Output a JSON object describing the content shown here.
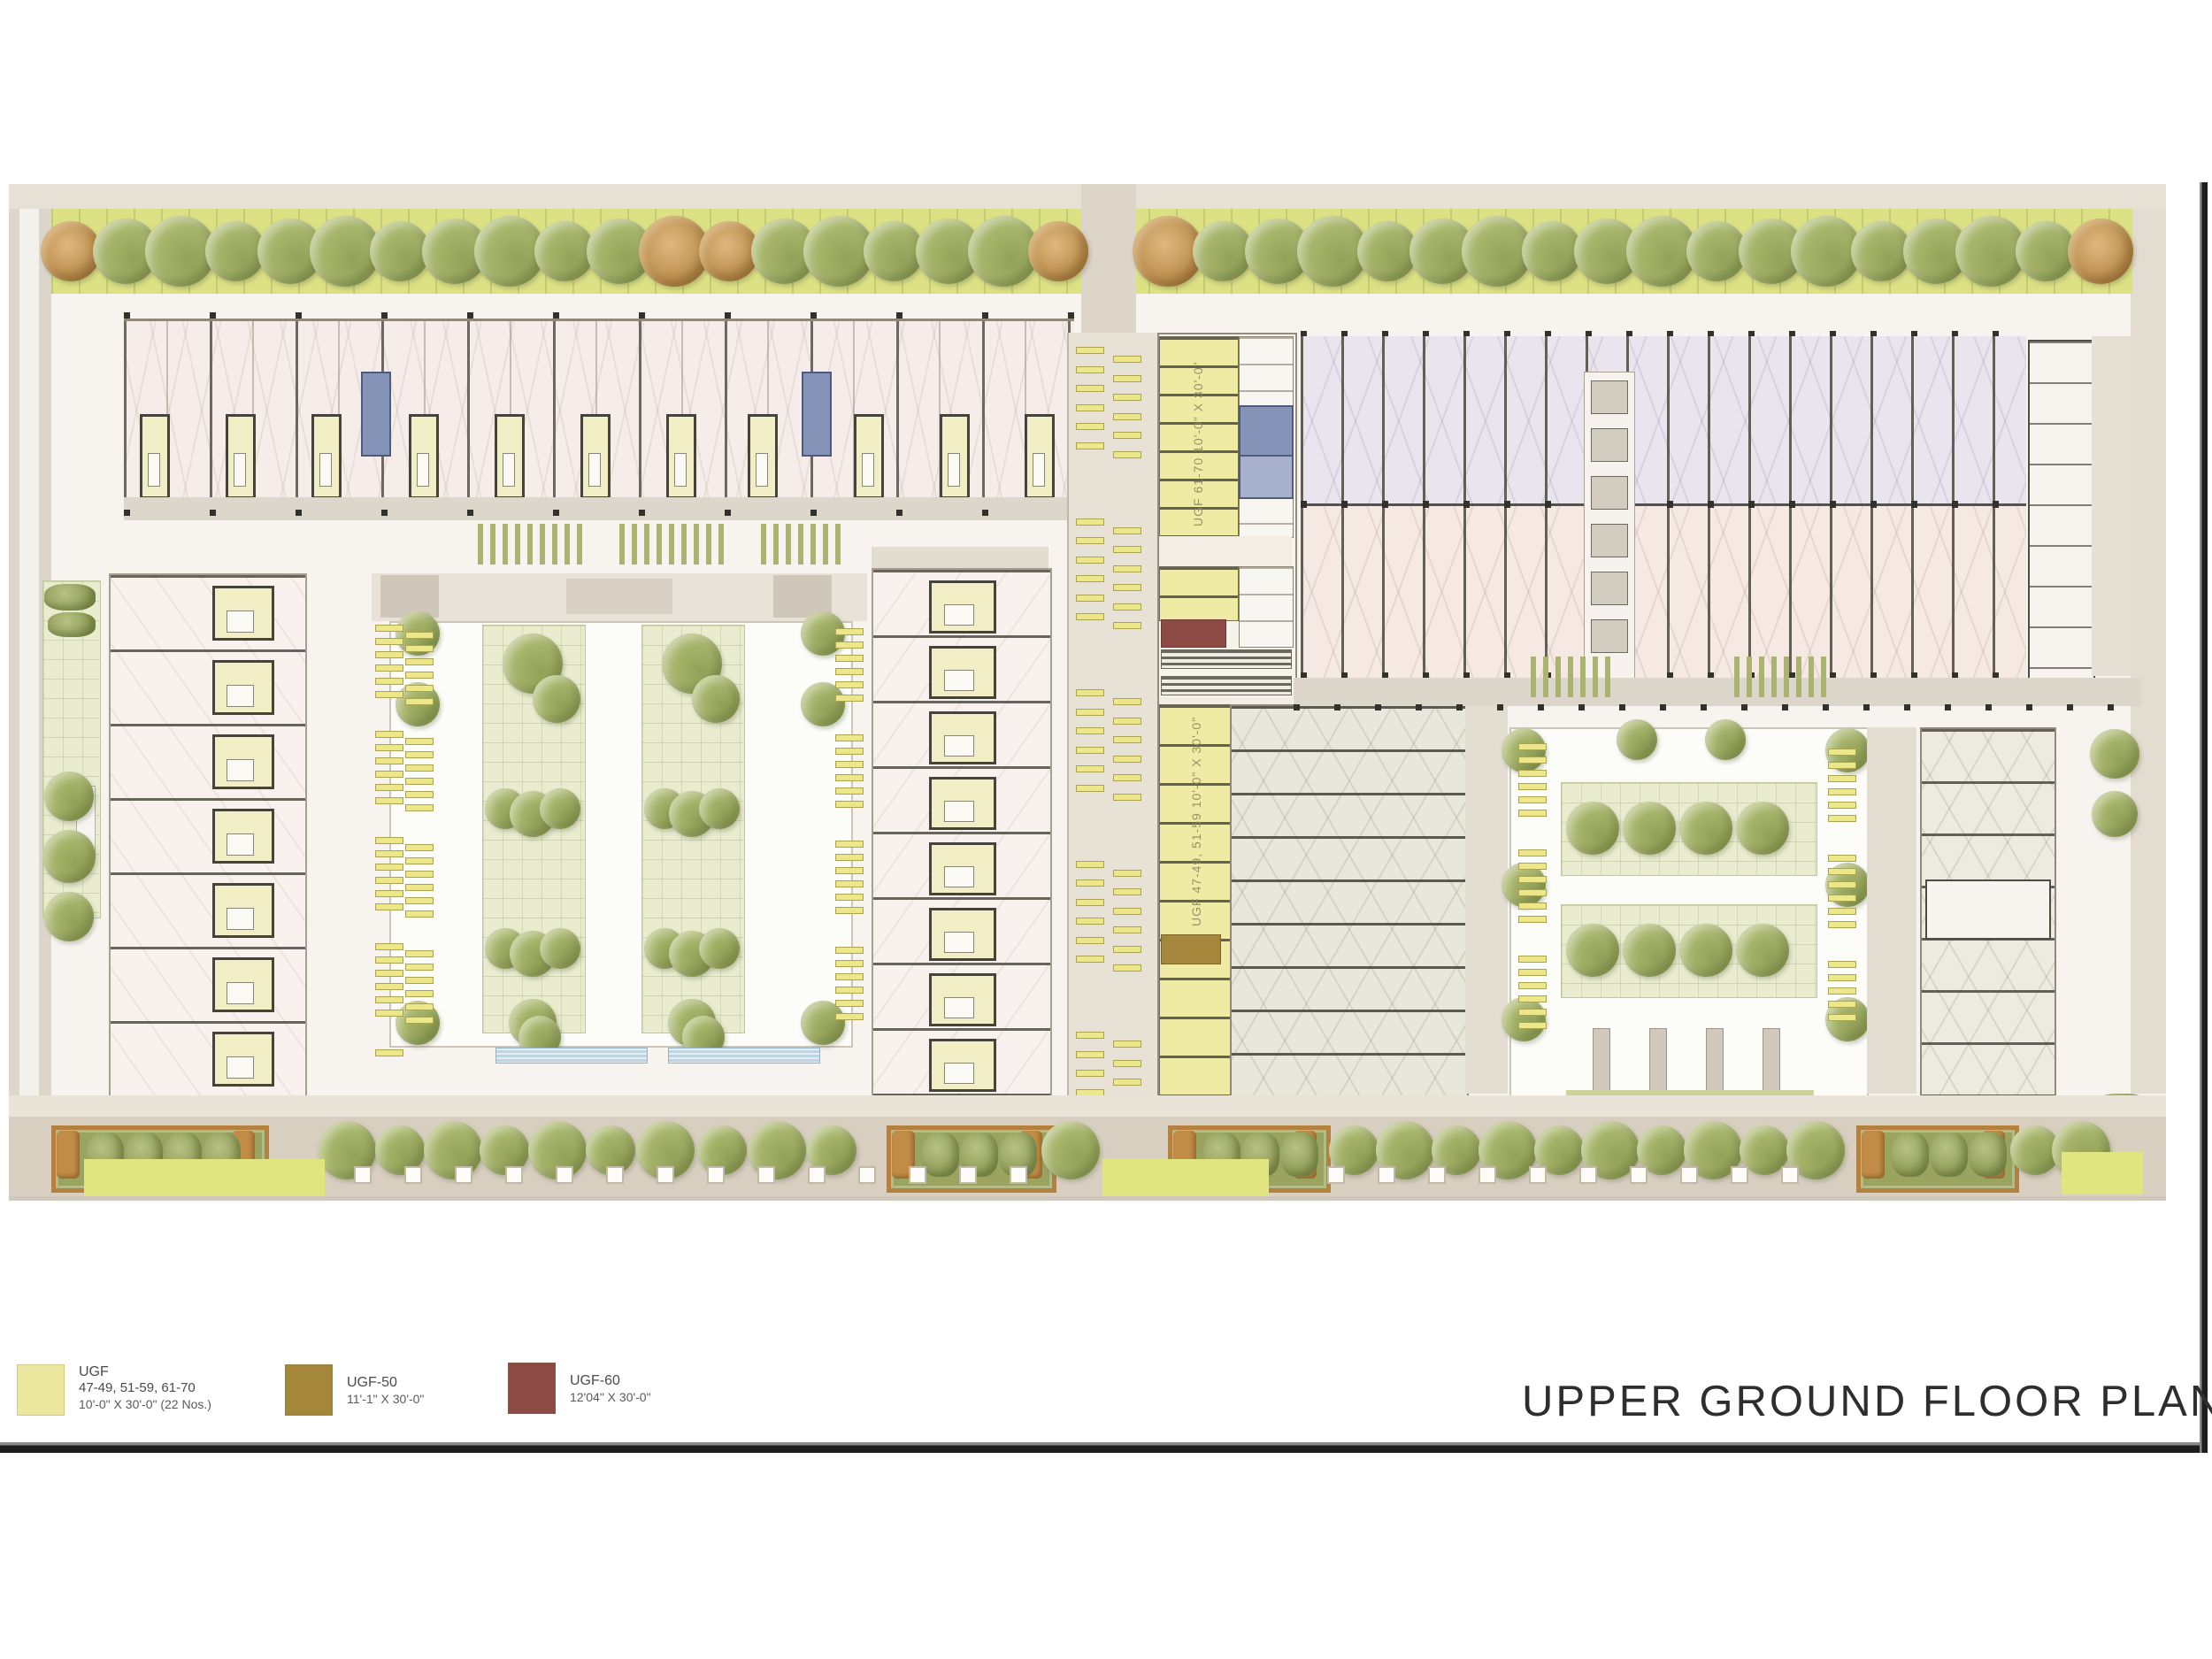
{
  "title": "UPPER GROUND FLOOR PLAN",
  "legend": {
    "items": [
      {
        "code": "UGF",
        "units": "47-49, 51-59, 61-70",
        "size": "10'-0\" X 30'-0\" (22 Nos.)",
        "color": "#ece79e"
      },
      {
        "code": "UGF-50",
        "units": "",
        "size": "11'-1\" X 30'-0\"",
        "color": "#a5873c"
      },
      {
        "code": "UGF-60",
        "units": "",
        "size": "12'04\" X 30'-0\"",
        "color": "#8e4a45"
      }
    ]
  },
  "plan": {
    "annotations": {
      "block_a_label": "UGF 61-70  10'-0\" X 30'-0\"",
      "block_b_label": "UGF 47-49, 51-59  10'-0\" X 30'-0\""
    },
    "colors": {
      "ugf_unit": "#ece79e",
      "ugf50_unit": "#a5873c",
      "ugf60_unit": "#8e4a45",
      "tree_canopy": "#a9b76d",
      "planting_verge": "#dce283",
      "stair_core": "#8593b8"
    }
  }
}
